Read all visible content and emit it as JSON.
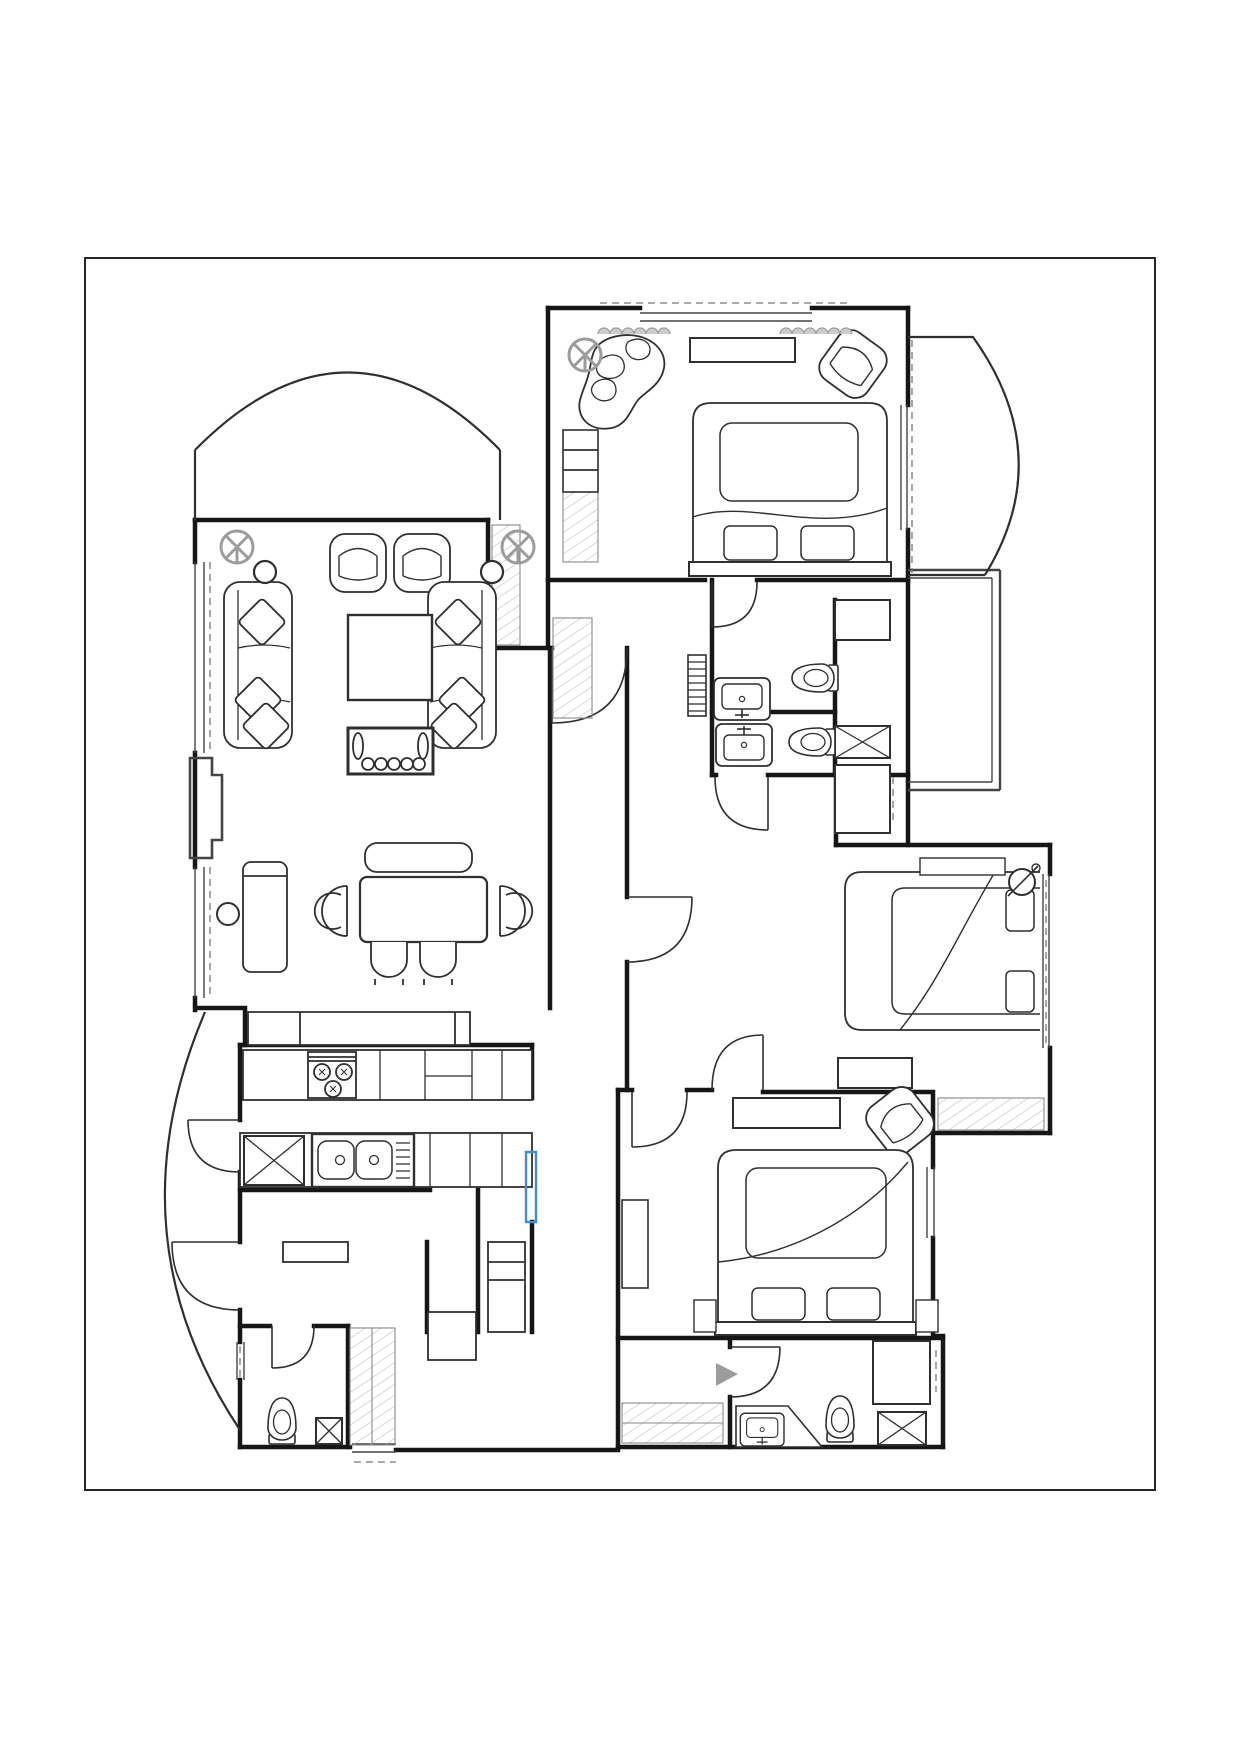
{
  "sheet": {
    "background": "#ffffff",
    "type": "apartment-floor-plan",
    "text_labels": []
  },
  "colors": {
    "frame": "#262626",
    "wall": "#161616",
    "furniture": "#2f2f2f",
    "thin": "#444444",
    "gray_symbol": "#9c9c9c",
    "curtain_fill": "#cccccc",
    "hatch": "#b9b9b9",
    "dash": "#777777",
    "highlight": "#3e8ed0",
    "background": "#ffffff"
  },
  "rooms": [
    {
      "name": "living-dining-room",
      "features": [
        "bay-window-arc",
        "window-wall",
        "sofa-left",
        "sofa-right",
        "coffee-table",
        "tv-console",
        "armchair-pair",
        "dining-table",
        "dining-bench",
        "sideboard",
        "stool"
      ]
    },
    {
      "name": "kitchen",
      "features": [
        "stove-3-burner",
        "double-bowl-sink",
        "counter-run",
        "service-shaft-x"
      ]
    },
    {
      "name": "bedroom-top",
      "features": [
        "double-bed",
        "organic-chaise",
        "rotated-armchair",
        "dresser",
        "curtain-scallops",
        "wardrobe-hatched"
      ]
    },
    {
      "name": "bedroom-right",
      "features": [
        "double-bed",
        "table-lamp",
        "low-cabinet",
        "headboard-right",
        "window-ledge-hatched"
      ]
    },
    {
      "name": "bedroom-bottom",
      "features": [
        "double-bed",
        "rotated-armchair",
        "dresser",
        "nightstands",
        "closet-hatched"
      ]
    },
    {
      "name": "bathroom-ensuite",
      "features": [
        "washbasin",
        "toilet",
        "radiator"
      ]
    },
    {
      "name": "bathroom-middle",
      "features": [
        "washbasin",
        "toilet",
        "shaft-x-box"
      ]
    },
    {
      "name": "bathroom-bottom",
      "features": [
        "washbasin-angled-vanity",
        "toilet",
        "shower-x-box",
        "shaft"
      ]
    },
    {
      "name": "wc-small",
      "features": [
        "toilet",
        "small-x-box",
        "hatched-closet"
      ]
    },
    {
      "name": "utility-room",
      "features": [
        "worktable",
        "shelf-column",
        "laundry-box",
        "exterior-threshold"
      ]
    },
    {
      "name": "hallway",
      "features": [
        "coat-closet-hatched",
        "door-swings"
      ]
    },
    {
      "name": "balcony-top-right",
      "shape": "curved-arc"
    },
    {
      "name": "balcony-bottom-left",
      "shape": "curved-arc"
    }
  ],
  "symbol_counts": {
    "ceiling_fans": 3,
    "door_swings": 11,
    "x_shaft_boxes": 4,
    "beds": 3,
    "toilets": 4,
    "washbasins": 4,
    "wall_sconces": 2
  },
  "highlight": {
    "type": "selected-wall-segment",
    "location": "corridor-near-kitchen",
    "color_ref": "highlight"
  }
}
